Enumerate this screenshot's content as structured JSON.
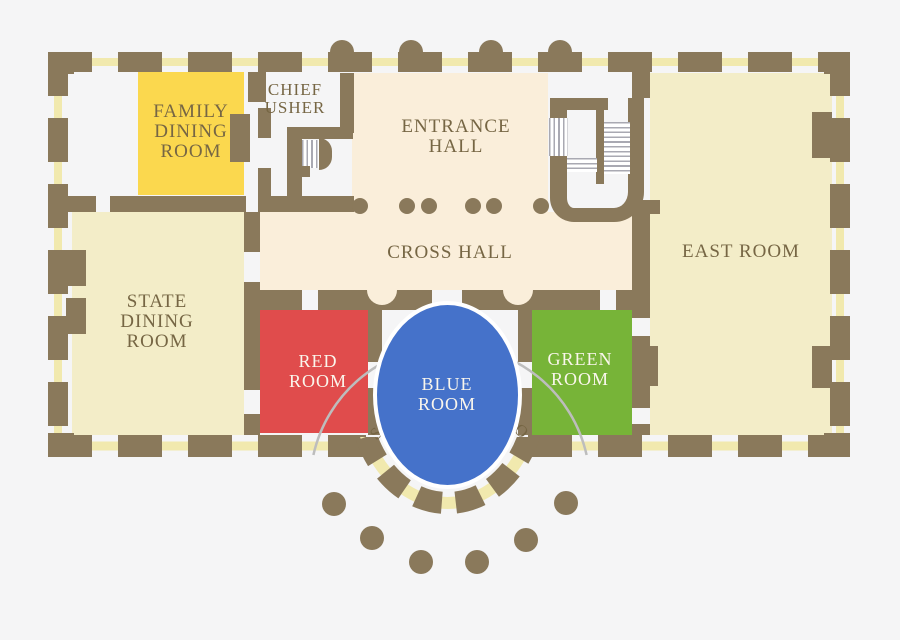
{
  "meta": {
    "title": "White House State Floor Plan"
  },
  "colors": {
    "background": "#f5f5f6",
    "wall": "#8a795b",
    "window": "#f1e9ae",
    "hall": "#faeeda",
    "room_pale": "#f3edc8",
    "family_yellow": "#fbd84e",
    "red": "#e04c4c",
    "blue": "#4572ca",
    "green": "#77b438",
    "ink": "#766644",
    "label_light": "#faf6ec",
    "arc_gray": "#bdbdbd",
    "stair_line": "#a9a9b2",
    "door_white": "#f5f5f6",
    "trim_white": "#ffffff"
  },
  "rooms": {
    "family_dining": {
      "lines": [
        "FAMILY",
        "DINING",
        "ROOM"
      ]
    },
    "chief_usher": {
      "lines": [
        "CHIEF",
        "USHER"
      ]
    },
    "entrance_hall": {
      "lines": [
        "ENTRANCE",
        "HALL"
      ]
    },
    "cross_hall": {
      "lines": [
        "CROSS HALL"
      ]
    },
    "state_dining": {
      "lines": [
        "STATE",
        "DINING",
        "ROOM"
      ]
    },
    "east_room": {
      "lines": [
        "EAST ROOM"
      ]
    },
    "red_room": {
      "lines": [
        "RED",
        "ROOM"
      ]
    },
    "blue_room": {
      "lines": [
        "BLUE",
        "ROOM"
      ]
    },
    "green_room": {
      "lines": [
        "GREEN",
        "ROOM"
      ]
    },
    "south_portico": {
      "label": "SOUTH PORTICO"
    }
  }
}
